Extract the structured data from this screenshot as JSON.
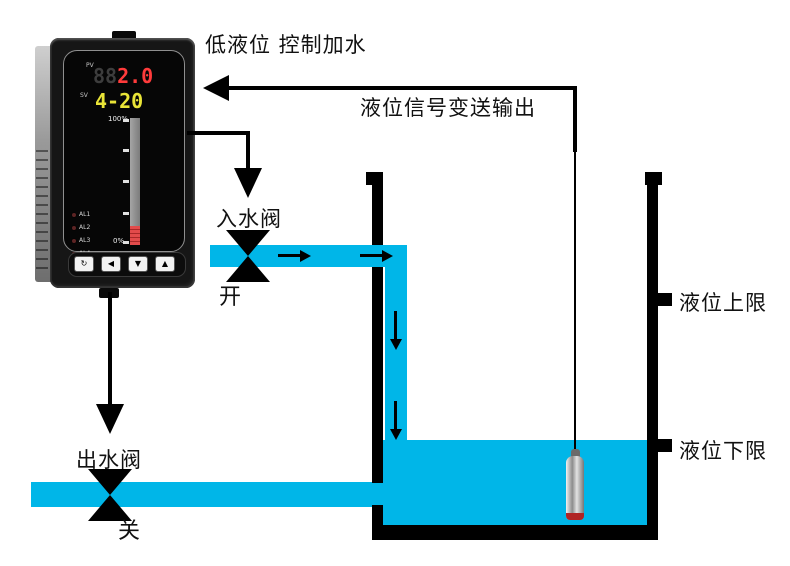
{
  "colors": {
    "water": "#00b6e8",
    "line": "#000000",
    "ghost": "#3d3d3d",
    "pv_value": "#ff3b3b",
    "sv_value": "#e9e437"
  },
  "captions": {
    "top": "低液位 控制加水",
    "signal": "液位信号变送输出",
    "inlet_valve": "入水阀",
    "inlet_state": "开",
    "outlet_valve": "出水阀",
    "outlet_state": "关",
    "upper_limit": "液位上限",
    "lower_limit": "液位下限"
  },
  "controller": {
    "pv_label": "PV",
    "pv_ghost": "88",
    "pv_value": "2.0",
    "sv_label": "SV",
    "sv_value": "4-20",
    "bar_top_label": "100%",
    "bar_bottom_label": "0%",
    "bar_fill_percent": 15,
    "leds": [
      "AL1",
      "AL2",
      "AL3",
      "AL4"
    ],
    "buttons": [
      {
        "name": "set-button",
        "glyph": "↻"
      },
      {
        "name": "shift-button",
        "glyph": "◀"
      },
      {
        "name": "down-button",
        "glyph": "▼"
      },
      {
        "name": "up-button",
        "glyph": "▲"
      }
    ]
  }
}
